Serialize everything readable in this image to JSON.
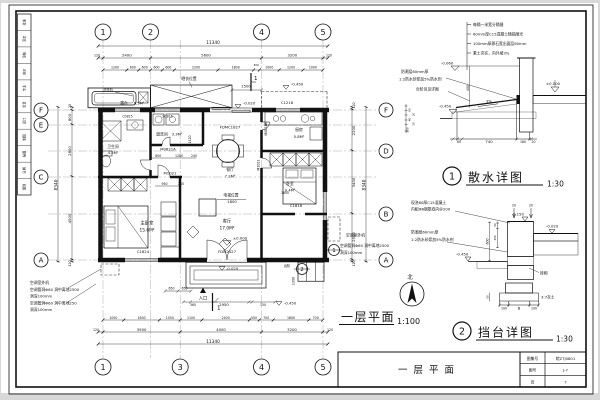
{
  "sheet": {
    "signature_cells": [
      "批准",
      "审定",
      "审核",
      "校对",
      "专业",
      "负责",
      "设计",
      "制图",
      "描图",
      "日期",
      "图别"
    ],
    "title_block": {
      "drawing_title": "一层平面",
      "rows": [
        {
          "label": "图集号",
          "value": "皖ZTJ0801"
        },
        {
          "label": "图号",
          "value": "J-7"
        },
        {
          "label": "页",
          "value": "7"
        }
      ]
    }
  },
  "plan": {
    "caption": "一层平面",
    "scale": "1:100",
    "north_label": "北",
    "axes": {
      "top": [
        "1",
        "2",
        "4",
        "5"
      ],
      "bottom": [
        "1",
        "3",
        "4",
        "5"
      ],
      "left": [
        "F",
        "E",
        "C",
        "A"
      ],
      "right": [
        "F",
        "D",
        "B",
        "A"
      ]
    },
    "dims": {
      "overall": "11340",
      "overall_v": "8340",
      "top_major": [
        "120",
        "2400",
        "5600",
        "3200",
        "120"
      ],
      "top_minor": [
        "1200",
        "600",
        "600",
        "600",
        "600",
        "2200",
        "1800",
        "300",
        "1000",
        "1200",
        "1000"
      ],
      "bottom_minor": [
        "1050",
        "1800",
        "1050",
        "1100",
        "2400",
        "500",
        "700",
        "1800",
        "700"
      ],
      "bottom_major": [
        "3900",
        "4000",
        "3200"
      ],
      "left": [
        "20",
        "800",
        "2800",
        "4500",
        "120"
      ],
      "right": [
        "120",
        "2200",
        "3400",
        "2500",
        "120"
      ],
      "misc": {
        "d1500": "1500",
        "d650a": "650",
        "d650b": "650",
        "d360": "360",
        "d2950": "2950",
        "d150": "150",
        "d1390": "1390",
        "d950": "950",
        "d240a": "240",
        "d800": "800",
        "d1280": "1280",
        "d240b": "240",
        "d1420": "1420",
        "d1800a": "1800",
        "d1800b": "1800",
        "d120bl": "120",
        "d120br": "120"
      }
    },
    "rooms": {
      "terrace": {
        "name": "露台",
        "area": "6.5M²"
      },
      "bath": {
        "name": "卫生间",
        "area": "4.5M²"
      },
      "laundry": {
        "name": "盥洗间",
        "area": "3.3M²"
      },
      "kitchen": {
        "name": "厨房",
        "area": "5.8M²"
      },
      "dining": {
        "name": "餐厅",
        "area": "7.2M²"
      },
      "bedroom": {
        "name": "卧室",
        "area": "9.4M²"
      },
      "master": {
        "name": "主卧室",
        "area": "15.6M²"
      },
      "living": {
        "name": "客厅",
        "area": "17.0M²"
      }
    },
    "openings": {
      "c0815": "C0815",
      "sc815": "SC815",
      "c1218": "C1218",
      "fdmc1827": "FDMC1827",
      "m0821a": "M0821A",
      "m0821b": "M0821B",
      "m1021": "M1021",
      "m1021b": "M1021",
      "c1818": "C1818",
      "c1824": "C1824",
      "fdm2427": "FDM2427"
    },
    "levels": {
      "zero": "±0.000",
      "n020_top": "-0.020",
      "n450_top": "-0.450",
      "n020_entry": "-0.020",
      "n450_side": "-0.450"
    },
    "labels": {
      "washer": "洗衣机",
      "drying": "晒衣位置",
      "tv": "电视位置",
      "entry": "入口",
      "steps": "台阶",
      "ac_unit_l": "空调室外机",
      "ac_hole_l1": "空调管洞Φ60 洞中离地2500",
      "ac_hole_l2": "洞深100mm",
      "ac_hole_l3": "空调管洞Φ60 洞中离地250",
      "ac_hole_l4": "洞深100mm",
      "ac_unit_r": "空调室外机",
      "ac_hole_r1": "空调管洞Φ60 洞中离地2500",
      "ac_hole_r2": "洞深100mm",
      "section_mark": "1",
      "detail_ref1": "1",
      "detail_ref2": "2"
    }
  },
  "detail1": {
    "ref_num": "1",
    "caption": "散水详图",
    "scale": "1:30",
    "notes": [
      "每隔一米宽分隔缝",
      "60mm厚C15混凝土随捣随光",
      "100mm厚卵石宽出面层60mm",
      "素土夯实，向外坡3%"
    ],
    "side_notes": [
      "防潮层60mm厚",
      "1:2防水砂浆加5%防水剂",
      "台阶另见详图"
    ],
    "levels": {
      "n060": "-0.060",
      "zero": "±0.000",
      "n450": "-0.450"
    },
    "dims": {
      "v400": "400",
      "slope": "3%",
      "d60": "60",
      "d740": "740",
      "d180": "180",
      "d20": "20",
      "s60": "60",
      "s20a": "20",
      "s40": "40",
      "s20b": "20",
      "s100": "100"
    }
  },
  "detail2": {
    "ref_num": "2",
    "caption": "挡台详图",
    "scale": "1:30",
    "notes": [
      "现浇60厚C15混凝土",
      "内配Φ6钢筋双向@200",
      "防潮层60mm厚",
      "1:2防水砂浆加5%防水剂"
    ],
    "levels": {
      "p150": "0.150",
      "n020": "-0.020",
      "n450": "-0.450"
    },
    "labels": {
      "brick": "砖砌",
      "lime": "3:7灰土"
    },
    "dims": {
      "t20a": "20",
      "t20b": "20",
      "s50": "50",
      "s150": "150",
      "v600": "600",
      "b50": "50",
      "b100a": "100",
      "bB": "B",
      "b100b": "100"
    }
  }
}
